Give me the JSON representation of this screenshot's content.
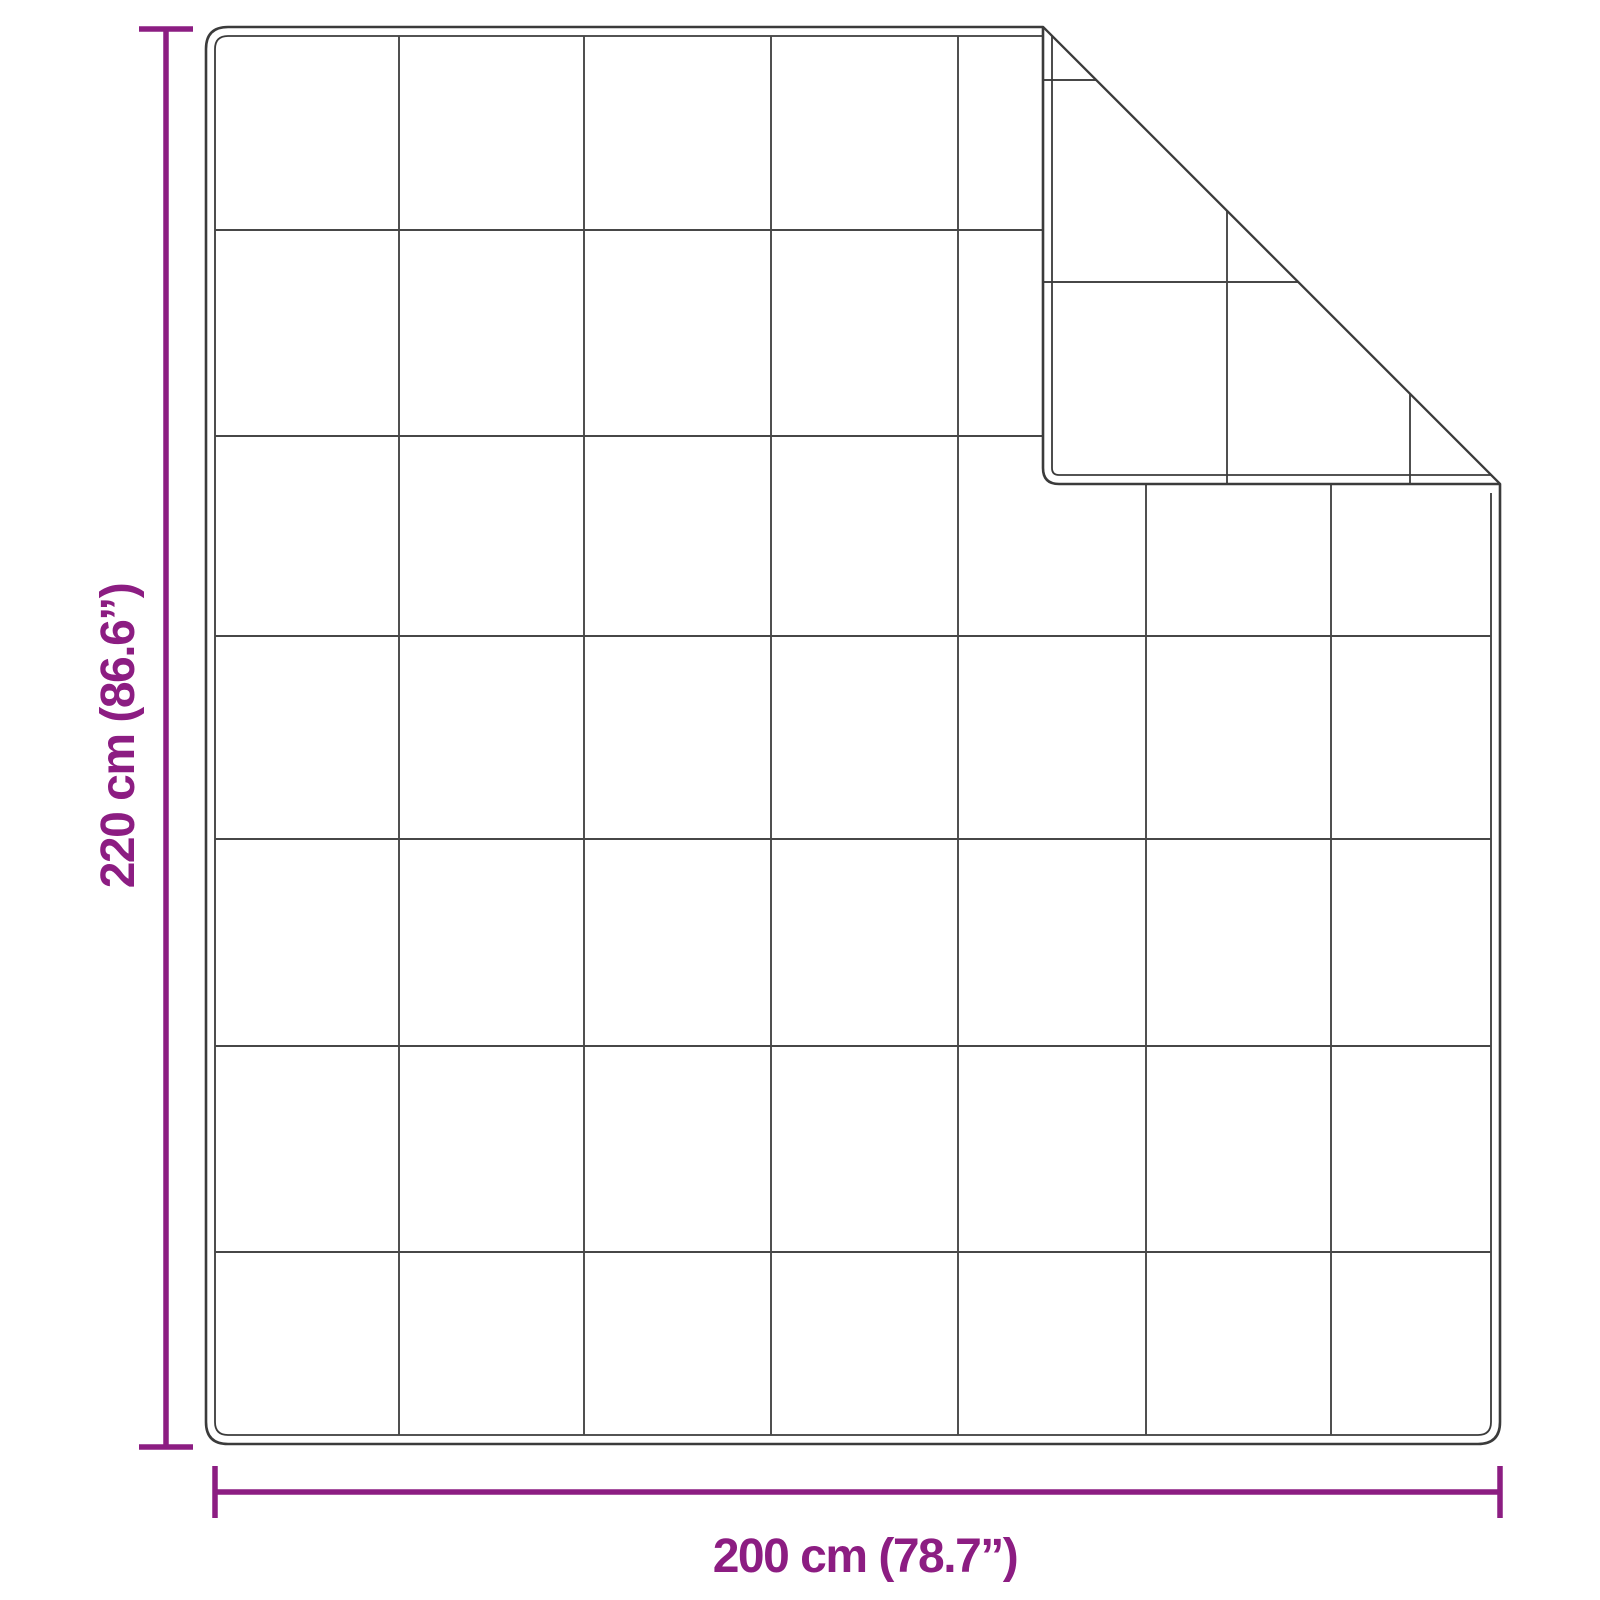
{
  "labels": {
    "height": "220 cm (86.6”)",
    "width": "200 cm (78.7”)"
  },
  "colors": {
    "accent": "#8C1D82",
    "outline": "#3B3B3B",
    "grid": "#474747",
    "background": "#FFFFFF"
  },
  "diagram": {
    "type": "product-dimension-diagram",
    "subject": "quilted-blanket-with-folded-corner",
    "canvas": {
      "width": 1600,
      "height": 1600
    },
    "blanket": {
      "x": 206,
      "y": 27,
      "width": 1294,
      "height": 1417,
      "corner_radius": 22,
      "inner_inset": 9
    },
    "fold": {
      "corner_x": 1043,
      "bottom_y": 484,
      "tip_radius": 16
    },
    "grid": {
      "v_full": [
        399,
        584,
        771,
        958
      ],
      "v_below_fold": [
        1146,
        1331
      ],
      "h_left_of_fold": [
        230,
        436
      ],
      "h_full": [
        636,
        839,
        1046,
        1252
      ]
    },
    "flap_grid": {
      "horizontal_y": [
        80,
        282
      ],
      "vertical_x": [
        1227,
        1410
      ]
    },
    "dimension_vertical": {
      "x": 166,
      "y1": 29,
      "y2": 1447,
      "cap_half_length": 27,
      "label_anchor": {
        "x": 134,
        "y": 736
      }
    },
    "dimension_horizontal": {
      "y": 1492,
      "x1": 215,
      "x2": 1500,
      "cap_half_length": 26,
      "label_anchor": {
        "x": 865,
        "y": 1572
      }
    },
    "stroke_widths": {
      "outer": 2.6,
      "inner": 1.8,
      "grid": 1.9,
      "crease": 2.0,
      "dimension": 5.5
    }
  }
}
